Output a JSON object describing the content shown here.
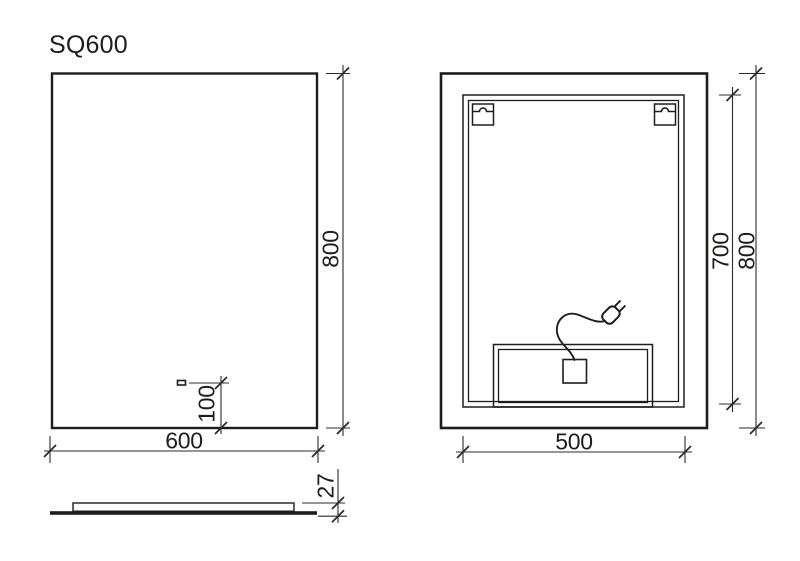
{
  "title": "SQ600",
  "colors": {
    "line": "#1d1d1b",
    "dimension": "#2b2b2b",
    "background": "#ffffff"
  },
  "front_view": {
    "width_label": "600",
    "height_label": "800",
    "sensor_offset_label": "100"
  },
  "side_view": {
    "thickness_label": "27"
  },
  "rear_view": {
    "backbox_width_label": "500",
    "backbox_height_label": "700",
    "height_label": "800"
  },
  "icons": {
    "power_plug": "power-plug-icon",
    "power_cord": "power-cord-icon",
    "hanger_bracket": "hanger-bracket-icon",
    "touch_sensor": "touch-sensor-icon"
  }
}
